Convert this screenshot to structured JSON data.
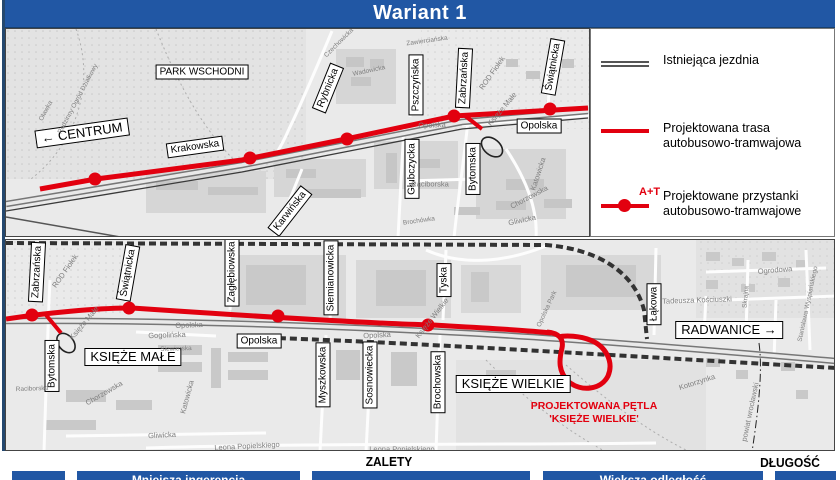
{
  "title": "Wariant 1",
  "colors": {
    "banner_blue": "#2157A4",
    "route_red": "#E2000F",
    "map_bg": "#EAEAEA"
  },
  "legend": {
    "items": [
      {
        "name": "legend-existing-road",
        "label": "Istniejąca jezdnia"
      },
      {
        "name": "legend-planned-route",
        "label": "Projektowana trasa autobusowo-tramwajowa"
      },
      {
        "name": "legend-planned-stops",
        "label": "Projektowane przystanki autobusowo-tramwajowe",
        "symbol_text": "A+T"
      }
    ]
  },
  "top_map": {
    "labels": [
      {
        "name": "area-label-park-wschodni",
        "text": "PARK WSCHODNI",
        "x": 196,
        "y": 43,
        "rot": 0,
        "kind": "wlabel"
      },
      {
        "name": "direction-label-centrum",
        "text": "← CENTRUM",
        "x": 76,
        "y": 104,
        "rot": -8,
        "kind": "wlabel big"
      },
      {
        "name": "street-label-krakowska",
        "text": "Krakowska",
        "x": 189,
        "y": 118,
        "rot": -8,
        "kind": "wlabel"
      },
      {
        "name": "street-label-rybnicka",
        "text": "Rybnicka",
        "x": 322,
        "y": 59,
        "rot": -68,
        "kind": "wlabel"
      },
      {
        "name": "street-label-karwinska",
        "text": "Karwińska",
        "x": 284,
        "y": 182,
        "rot": -52,
        "kind": "wlabel"
      },
      {
        "name": "street-label-glubczycka",
        "text": "Głubczycka",
        "x": 406,
        "y": 140,
        "rot": -90,
        "kind": "wlabel"
      },
      {
        "name": "street-label-pszczynska",
        "text": "Pszczyńska",
        "x": 410,
        "y": 56,
        "rot": -90,
        "kind": "wlabel"
      },
      {
        "name": "street-label-zabrzanska",
        "text": "Zabrzańska",
        "x": 458,
        "y": 49,
        "rot": -87,
        "kind": "wlabel"
      },
      {
        "name": "street-label-swiatnicka",
        "text": "Świątnicka",
        "x": 547,
        "y": 38,
        "rot": -80,
        "kind": "wlabel"
      },
      {
        "name": "street-label-bytomska",
        "text": "Bytomska",
        "x": 467,
        "y": 140,
        "rot": -90,
        "kind": "wlabel"
      },
      {
        "name": "street-label-opolska",
        "text": "Opolska",
        "x": 533,
        "y": 97,
        "rot": 0,
        "kind": "wlabel"
      },
      {
        "name": "maptext-rod-fiolek",
        "text": "ROD Fiołek",
        "x": 486,
        "y": 44,
        "rot": -55,
        "kind": "maptext"
      },
      {
        "name": "maptext-ksieze-male",
        "text": "Księże Małe",
        "x": 496,
        "y": 80,
        "rot": -50,
        "kind": "maptext"
      },
      {
        "name": "maptext-opolska-road",
        "text": "Opolska",
        "x": 426,
        "y": 96,
        "rot": -2,
        "kind": "maptext"
      },
      {
        "name": "maptext-raciborska",
        "text": "Raciborska",
        "x": 424,
        "y": 155,
        "rot": 0,
        "kind": "maptext"
      },
      {
        "name": "maptext-katowicka",
        "text": "Katowicka",
        "x": 532,
        "y": 145,
        "rot": -72,
        "kind": "maptext"
      },
      {
        "name": "maptext-chorzowska",
        "text": "Chorzowska",
        "x": 523,
        "y": 168,
        "rot": -28,
        "kind": "maptext"
      },
      {
        "name": "maptext-gliwicka",
        "text": "Gliwicka",
        "x": 516,
        "y": 191,
        "rot": -12,
        "kind": "maptext"
      },
      {
        "name": "maptext-brochowka",
        "text": "Brochówka",
        "x": 413,
        "y": 192,
        "rot": -8,
        "kind": "maptext sm"
      },
      {
        "name": "maptext-wadowicka",
        "text": "Wadowicka",
        "x": 363,
        "y": 42,
        "rot": -12,
        "kind": "maptext sm"
      },
      {
        "name": "maptext-zawiercianska",
        "text": "Zawierciańska",
        "x": 421,
        "y": 12,
        "rot": -8,
        "kind": "maptext sm"
      },
      {
        "name": "maptext-czechowicka",
        "text": "Czechowicka",
        "x": 333,
        "y": 14,
        "rot": -45,
        "kind": "maptext sm"
      },
      {
        "name": "maptext-rodzinny-ogrod",
        "text": "Rodzinny Ogród Działkowy",
        "x": 72,
        "y": 70,
        "rot": -62,
        "kind": "maptext sm"
      },
      {
        "name": "maptext-olawka",
        "text": "Oławka",
        "x": 40,
        "y": 82,
        "rot": -62,
        "kind": "maptext sm"
      }
    ]
  },
  "bottom_map": {
    "labels": [
      {
        "name": "street-label-zabrzanska-b",
        "text": "Zabrzańska",
        "x": 31,
        "y": 32,
        "rot": -87,
        "kind": "wlabel"
      },
      {
        "name": "street-label-swiatnicka-b",
        "text": "Świątnicka",
        "x": 122,
        "y": 33,
        "rot": -80,
        "kind": "wlabel"
      },
      {
        "name": "street-label-zaglebiowska",
        "text": "Zagłębiowska",
        "x": 226,
        "y": 32,
        "rot": -90,
        "kind": "wlabel"
      },
      {
        "name": "street-label-siemianowicka",
        "text": "Siemianowicka",
        "x": 325,
        "y": 38,
        "rot": -90,
        "kind": "wlabel"
      },
      {
        "name": "street-label-tyska",
        "text": "Tyska",
        "x": 438,
        "y": 40,
        "rot": -90,
        "kind": "wlabel"
      },
      {
        "name": "street-label-myszkowska",
        "text": "Myszkowska",
        "x": 317,
        "y": 135,
        "rot": -90,
        "kind": "wlabel"
      },
      {
        "name": "street-label-sosnowiecka",
        "text": "Sosnowiecka",
        "x": 364,
        "y": 135,
        "rot": -90,
        "kind": "wlabel"
      },
      {
        "name": "street-label-brochowska",
        "text": "Brochowska",
        "x": 432,
        "y": 142,
        "rot": -90,
        "kind": "wlabel"
      },
      {
        "name": "street-label-bytomska-b",
        "text": "Bytomska",
        "x": 46,
        "y": 126,
        "rot": -90,
        "kind": "wlabel"
      },
      {
        "name": "street-label-opolska-b",
        "text": "Opolska",
        "x": 253,
        "y": 101,
        "rot": 0,
        "kind": "wlabel"
      },
      {
        "name": "street-label-lakowa",
        "text": "Łąkowa",
        "x": 648,
        "y": 64,
        "rot": -90,
        "kind": "wlabel"
      },
      {
        "name": "direction-label-radwanice",
        "text": "RADWANICE →",
        "x": 723,
        "y": 90,
        "rot": 0,
        "kind": "wlabel big"
      },
      {
        "name": "area-label-ksieze-male",
        "text": "KSIĘŻE MAŁE",
        "x": 127,
        "y": 117,
        "rot": 0,
        "kind": "wlabel big"
      },
      {
        "name": "area-label-ksieze-wielkie",
        "text": "KSIĘŻE WIELKIE",
        "x": 507,
        "y": 144,
        "rot": 0,
        "kind": "wlabel big"
      },
      {
        "name": "annotation-petla-line1",
        "text": "PROJEKTOWANA PĘTLA",
        "x": 588,
        "y": 166,
        "rot": 0,
        "kind": "rednote"
      },
      {
        "name": "annotation-petla-line2",
        "text": "'KSIĘŻE WIELKIE'",
        "x": 588,
        "y": 179,
        "rot": 0,
        "kind": "rednote"
      },
      {
        "name": "maptext-rod-fiolek-b",
        "text": "ROD Fiołek",
        "x": 59,
        "y": 31,
        "rot": -55,
        "kind": "maptext"
      },
      {
        "name": "maptext-ksieze-male-road",
        "text": "Księże Małe",
        "x": 78,
        "y": 83,
        "rot": -50,
        "kind": "maptext"
      },
      {
        "name": "maptext-opolska-road-1",
        "text": "Opolska",
        "x": 183,
        "y": 85,
        "rot": -2,
        "kind": "maptext"
      },
      {
        "name": "maptext-opolska-road-2",
        "text": "Opolska",
        "x": 371,
        "y": 95,
        "rot": -3,
        "kind": "maptext"
      },
      {
        "name": "maptext-ksieze-wielkie-road",
        "text": "Księże Wielkie",
        "x": 426,
        "y": 78,
        "rot": -52,
        "kind": "maptext"
      },
      {
        "name": "maptext-gogolinska",
        "text": "Gogolińska",
        "x": 161,
        "y": 95,
        "rot": -2,
        "kind": "maptext"
      },
      {
        "name": "maptext-siewierska",
        "text": "Siewierska",
        "x": 170,
        "y": 109,
        "rot": -2,
        "kind": "maptext sm"
      },
      {
        "name": "maptext-katowicka-b",
        "text": "Katowicka",
        "x": 181,
        "y": 157,
        "rot": -75,
        "kind": "maptext"
      },
      {
        "name": "maptext-chorzowska-b",
        "text": "Chorzowska",
        "x": 98,
        "y": 153,
        "rot": -30,
        "kind": "maptext"
      },
      {
        "name": "maptext-gliwicka-b",
        "text": "Gliwicka",
        "x": 156,
        "y": 195,
        "rot": -3,
        "kind": "maptext"
      },
      {
        "name": "maptext-raciborska-b",
        "text": "Raciborska",
        "x": 26,
        "y": 149,
        "rot": -2,
        "kind": "maptext sm"
      },
      {
        "name": "maptext-tadeusza-kosciuszki",
        "text": "Tadeusza Kościuszki",
        "x": 691,
        "y": 60,
        "rot": -2,
        "kind": "maptext"
      },
      {
        "name": "maptext-ogrodowa",
        "text": "Ogrodowa",
        "x": 769,
        "y": 30,
        "rot": -5,
        "kind": "maptext"
      },
      {
        "name": "maptext-skrajna",
        "text": "Skrajna",
        "x": 740,
        "y": 57,
        "rot": -85,
        "kind": "maptext sm"
      },
      {
        "name": "maptext-wyspianskiego",
        "text": "Stanisława Wyspiańskiego",
        "x": 802,
        "y": 64,
        "rot": -78,
        "kind": "maptext sm"
      },
      {
        "name": "maptext-powiat-wroclawski",
        "text": "powiat wrocławski",
        "x": 744,
        "y": 172,
        "rot": -78,
        "kind": "maptext"
      },
      {
        "name": "maptext-kotorzynka",
        "text": "Kotorzynka",
        "x": 691,
        "y": 142,
        "rot": -18,
        "kind": "maptext"
      },
      {
        "name": "maptext-opolska-park",
        "text": "Opolska Park",
        "x": 541,
        "y": 69,
        "rot": -65,
        "kind": "maptext sm"
      },
      {
        "name": "maptext-leona-popielskiego-1",
        "text": "Leona Popielskiego",
        "x": 241,
        "y": 206,
        "rot": -3,
        "kind": "maptext"
      },
      {
        "name": "maptext-leona-popielskiego-2",
        "text": "Leona Popielskiego",
        "x": 396,
        "y": 209,
        "rot": 0,
        "kind": "maptext"
      }
    ]
  },
  "footer": {
    "zalety": "ZALETY",
    "dlugosc": "DŁUGOŚĆ",
    "bars": [
      {
        "x": 12,
        "w": 53,
        "label": ""
      },
      {
        "x": 77,
        "w": 223,
        "label": "Mniejsza ingerencja"
      },
      {
        "x": 312,
        "w": 218,
        "label": ""
      },
      {
        "x": 543,
        "w": 220,
        "label": "Większa odległość"
      },
      {
        "x": 775,
        "w": 61,
        "label": ""
      }
    ]
  }
}
